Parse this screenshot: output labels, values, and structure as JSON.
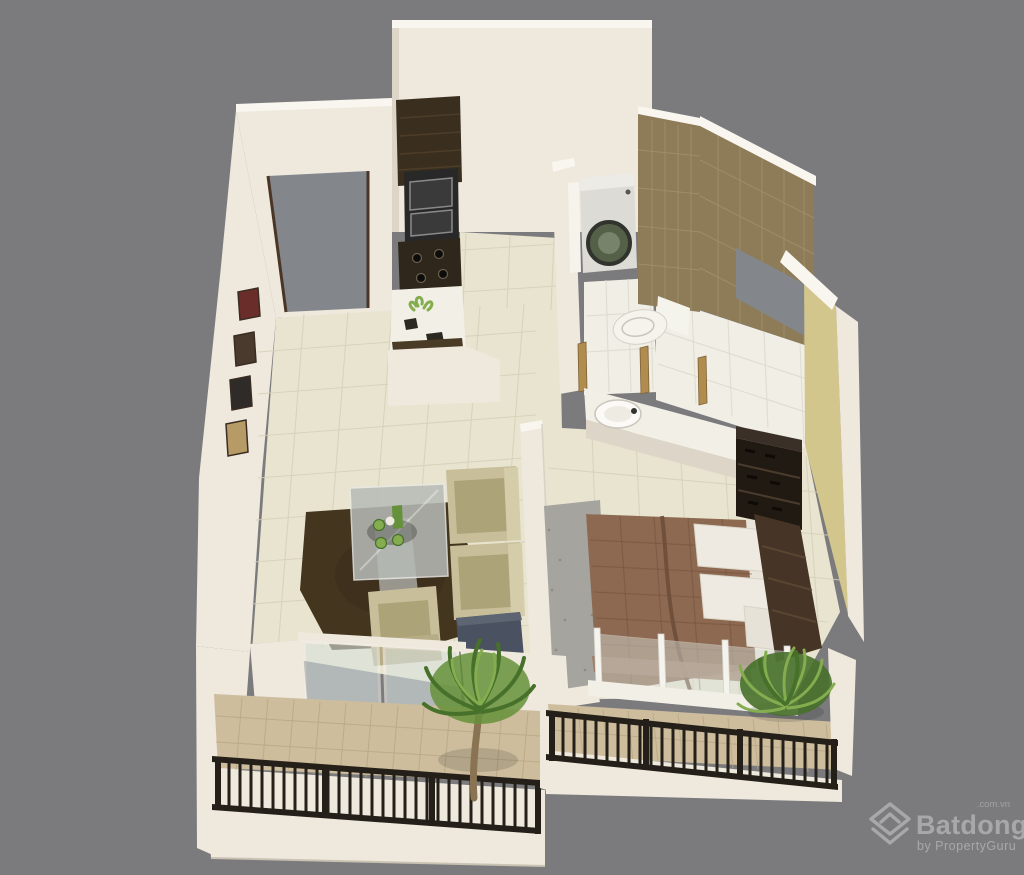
{
  "watermark": {
    "brand": "Batdongsan",
    "suffix": ".com.vn",
    "byline": "by PropertyGuru"
  },
  "scene": {
    "type": "3d-isometric-floor-plan-render",
    "subject": "one-bedroom apartment cutaway viewed from above",
    "rooms": [
      {
        "name": "living-room",
        "objects": [
          "entrance-doorway",
          "wall-picture-frames",
          "glass-dining-table",
          "green-tableware",
          "dark-shag-rug",
          "armchair",
          "armchair",
          "lounge-chair",
          "side-table"
        ]
      },
      {
        "name": "kitchen",
        "objects": [
          "tall-dark-cabinet",
          "built-in-oven",
          "cooktop-with-burners",
          "white-counter-with-sink",
          "decor-plant"
        ]
      },
      {
        "name": "bathroom",
        "objects": [
          "washing-machine",
          "toilet",
          "brown-wall-tiles",
          "white-floor-tiles",
          "wooden-door-jambs"
        ]
      },
      {
        "name": "utility-room",
        "objects": [
          "window-opening",
          "brown-wall-tiles",
          "white-floor-tiles"
        ]
      },
      {
        "name": "bedroom",
        "objects": [
          "double-bed-brown-blanket",
          "white-pillows",
          "dark-headboard",
          "shoe-shelf-wardrobe",
          "washbasin-counter",
          "gray-rug",
          "glass-balustrade",
          "khaki-accent-wall"
        ]
      },
      {
        "name": "living-balcony",
        "objects": [
          "palm-plant",
          "black-metal-railing",
          "sliding-glass-door",
          "tan-tile-floor"
        ]
      },
      {
        "name": "bedroom-balcony",
        "objects": [
          "fern-plant",
          "black-metal-railing",
          "tan-tile-floor"
        ]
      }
    ]
  },
  "palette": {
    "bg": "#7b7b7e",
    "wall": "#eee8dd",
    "wall-top": "#f9f6ef",
    "wall-shade": "#ddd6c8",
    "wall-dark": "#cdc5b5",
    "floor-cream": "#e8e4cf",
    "floor-line": "#d5d0b9",
    "floor-tan": "#cdbd9d",
    "tan-line": "#b7a682",
    "tile-white": "#f0eee5",
    "tile-white-line": "#dcd9cd",
    "brown-tile": "#8d7c57",
    "brown-grout": "#a99a73",
    "khaki": "#d3c68d",
    "doorway": "#83868b",
    "door-frame": "#4a3526",
    "gold": "#b08d4f",
    "dark-wood": "#3a2e1e",
    "oven": "#282828",
    "counter": "#f2efe6",
    "appliance": "#dcdbd5",
    "appliance-door": "#556049",
    "toilet": "#f4f3ec",
    "blanket": "#8c6950",
    "blanket-dark": "#6e4e39",
    "pillow": "#efeae1",
    "headboard": "#463526",
    "wardrobe": "#211a13",
    "rug-gray": "#a6a49e",
    "rug-brown": "#44351f",
    "sofa": "#c8bf9a",
    "sofa-dark": "#ada379",
    "sofa-light": "#d5cdaa",
    "glass": "#d8e2dd",
    "glass-table": "#b7bcb7",
    "side-table": "#4a5160",
    "plant": "#65913a",
    "plant-dark": "#47702a",
    "plant-light": "#83ad4f",
    "trunk": "#8a7352",
    "rail": "#242019",
    "watermark": "#ffffff"
  }
}
